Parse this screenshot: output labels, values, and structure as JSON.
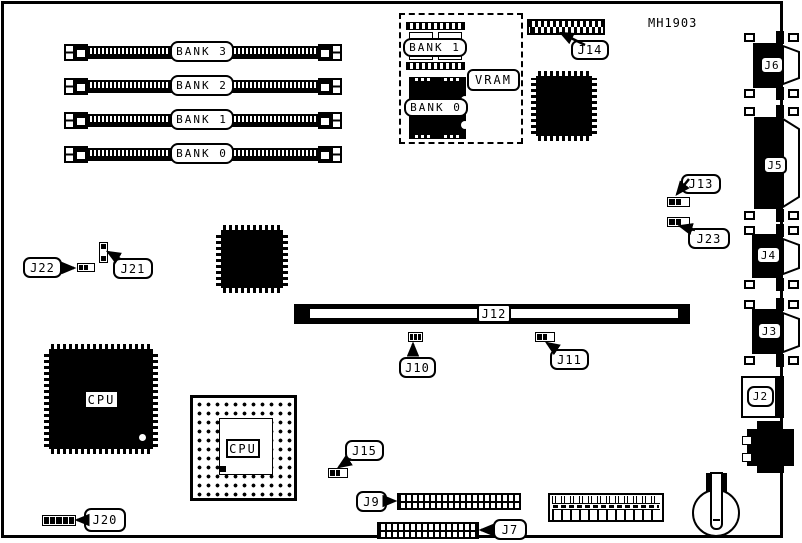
{
  "diagram": {
    "part_number": "MH1903",
    "memory_banks": [
      "BANK 3",
      "BANK 2",
      "BANK 1",
      "BANK 0"
    ],
    "vram_area": {
      "bank1": "BANK 1",
      "bank0": "BANK 0",
      "vram": "VRAM"
    },
    "cpu_qfp_label": "CPU",
    "cpu_pga_label": "CPU",
    "callouts": {
      "j2": "J2",
      "j3": "J3",
      "j4": "J4",
      "j5": "J5",
      "j6": "J6",
      "j7": "J7",
      "j9": "J9",
      "j10": "J10",
      "j11": "J11",
      "j12": "J12",
      "j13": "J13",
      "j14": "J14",
      "j15": "J15",
      "j20": "J20",
      "j21": "J21",
      "j22": "J22",
      "j23": "J23"
    }
  }
}
